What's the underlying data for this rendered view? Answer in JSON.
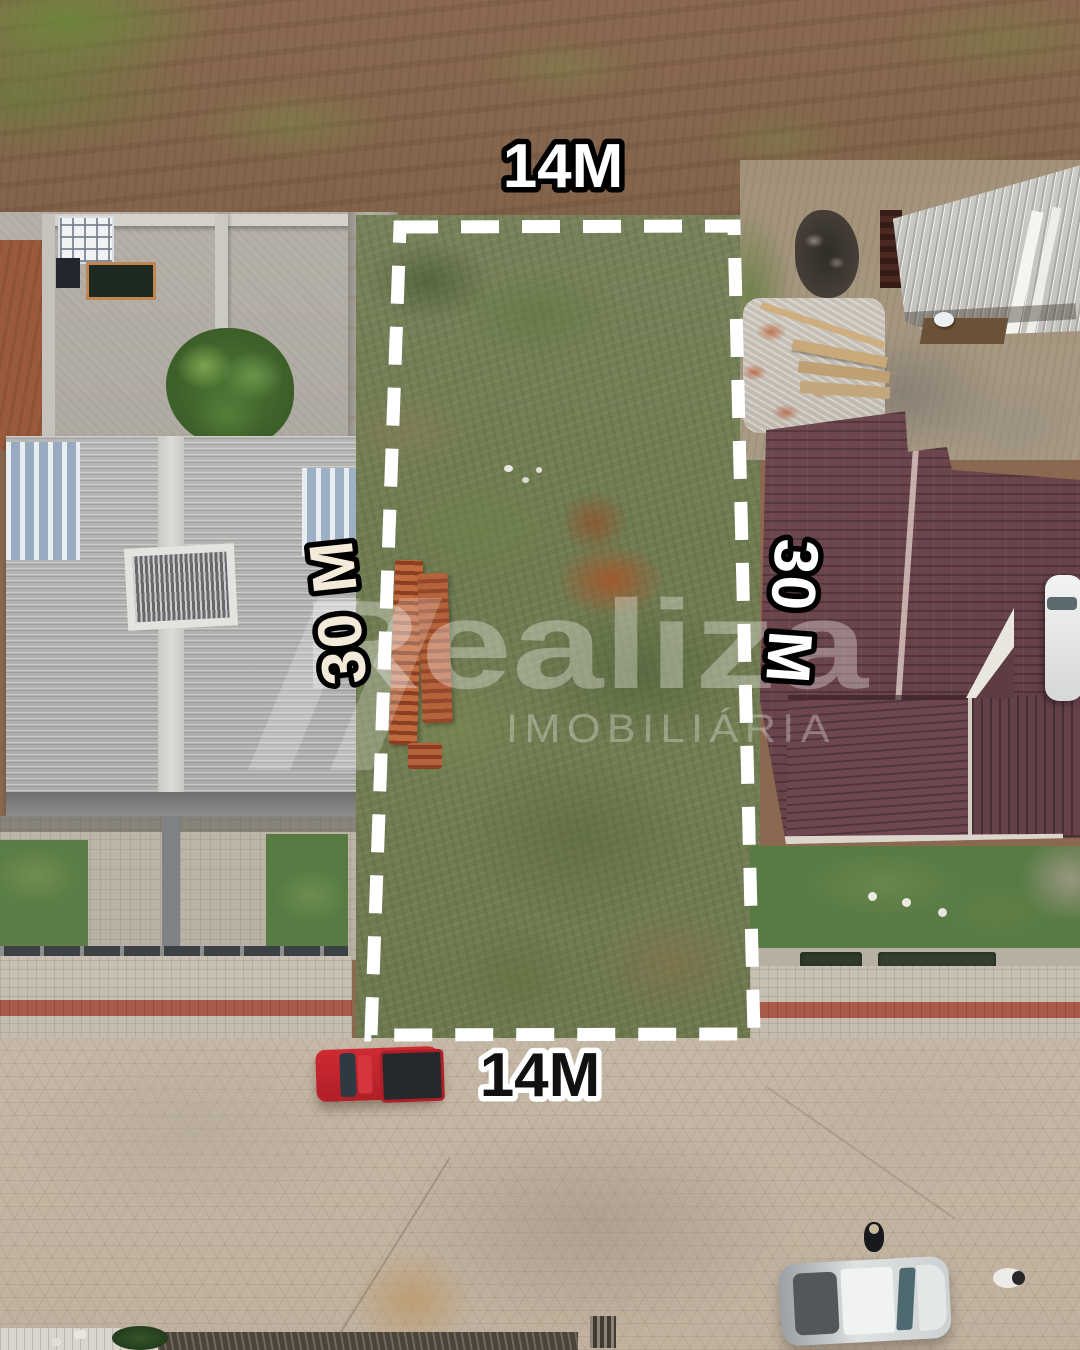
{
  "meta": {
    "type": "aerial-drone-photo",
    "subject": "vacant residential lot outlined for sale between two houses"
  },
  "dimensions": {
    "top": "14M",
    "bottom": "14M",
    "left": "30 M",
    "right": "30 M"
  },
  "watermark": {
    "brand": "Realiza",
    "subtitle": "IMOBILIÁRIA"
  },
  "colors": {
    "boundary_dash": "#ffffff",
    "label_fill_light": "#ffffff",
    "label_fill_cream": "#f3ead9",
    "label_fill_dark": "#111111",
    "label_stroke_dark": "#000000",
    "label_stroke_light": "#ffffff",
    "maroon_roof": "#6a444b",
    "gray_roof": "#b4b4b2",
    "lot_grass": "#717c53",
    "street_pavers": "#c3b5a2",
    "truck_red": "#b8242c"
  }
}
